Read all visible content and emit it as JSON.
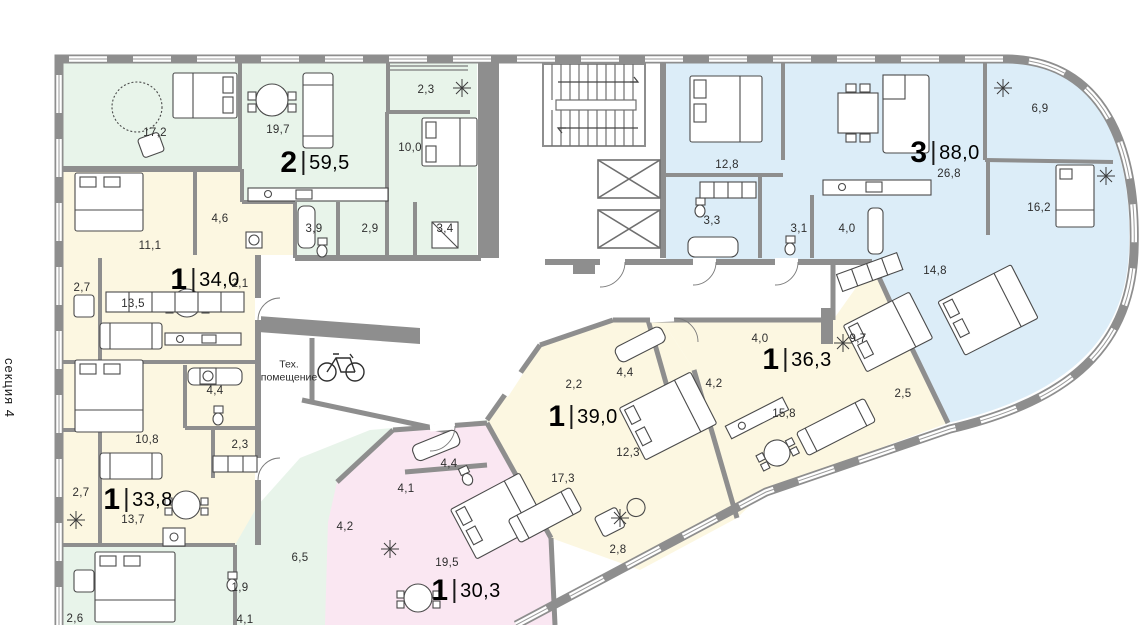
{
  "section_label": "секция 4",
  "tech_room": {
    "line1": "Тех.",
    "line2": "помещение"
  },
  "palette": {
    "green": "#e8f4ea",
    "yellow": "#fcf7e1",
    "blue": "#dcedf8",
    "pink": "#fae7f2",
    "wall": "#8e8e8e",
    "furniture_stroke": "#4a4a4a"
  },
  "apartments": [
    {
      "rooms_count": "2",
      "area": "59,5",
      "color_key": "green",
      "room_areas": [
        "17,2",
        "19,7",
        "10,0",
        "2,3",
        "3,9",
        "2,9",
        "3,4"
      ]
    },
    {
      "rooms_count": "1",
      "area": "34,0",
      "color_key": "yellow",
      "room_areas": [
        "11,1",
        "4,6",
        "2,7",
        "13,5",
        "2,1",
        "4,4"
      ]
    },
    {
      "rooms_count": "1",
      "area": "33,8",
      "color_key": "yellow",
      "room_areas": [
        "10,8",
        "2,3",
        "2,7",
        "13,7",
        "1,9"
      ]
    },
    {
      "rooms_count": "1",
      "area": "30,3",
      "color_key": "pink",
      "room_areas": [
        "4,4",
        "4,1",
        "19,5"
      ]
    },
    {
      "rooms_count": "1",
      "area": "39,0",
      "color_key": "yellow",
      "room_areas": [
        "2,2",
        "4,4",
        "12,3",
        "17,3",
        "2,8"
      ]
    },
    {
      "rooms_count": "1",
      "area": "36,3",
      "color_key": "yellow",
      "room_areas": [
        "4,0",
        "4,2",
        "9,7",
        "15,8",
        "2,5"
      ]
    },
    {
      "rooms_count": "3",
      "area": "88,0",
      "color_key": "blue",
      "room_areas": [
        "12,8",
        "26,8",
        "3,3",
        "3,1",
        "4,0",
        "14,8",
        "6,9",
        "16,2"
      ]
    }
  ],
  "partial_rooms": [
    "6,5",
    "4,2",
    "2,6",
    "4,1"
  ]
}
